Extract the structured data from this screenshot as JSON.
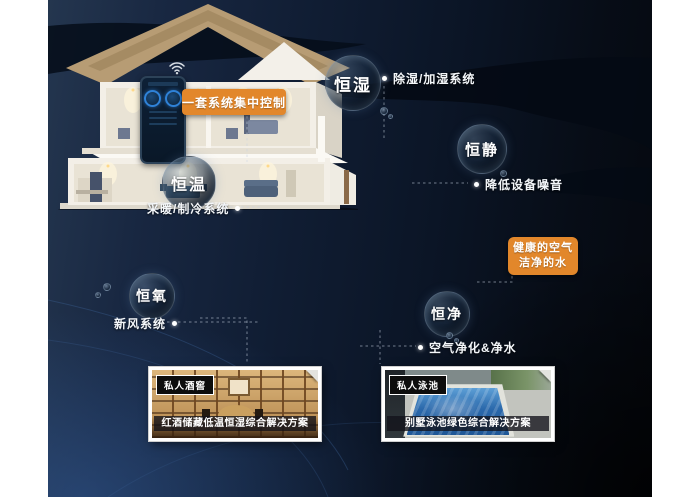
{
  "icons": {
    "phone_wifi": "wifi-icon",
    "corner_fold": "corner-fold-icon",
    "connector_dot": "connector-dot"
  },
  "colors": {
    "accent_orange": "#E2872B",
    "background_navy": "#111F35",
    "deep_shadow": "#05080E",
    "curve_line_blue": "#3F679F",
    "pool_blue": "#2A68AB",
    "wood_tan": "#C79E63",
    "roof_tan": "#B79C74",
    "text_white": "#FFFFFF"
  },
  "control_label": {
    "text": "一套系统集中控制"
  },
  "features": [
    {
      "bubble": "恒湿",
      "desc": "除湿/加湿系统"
    },
    {
      "bubble": "恒静",
      "desc": "降低设备噪音"
    },
    {
      "bubble": "恒温",
      "desc": "采暖/制冷系统"
    },
    {
      "bubble": "恒氧",
      "desc": "新风系统"
    },
    {
      "bubble": "恒净",
      "desc": "空气净化&净水"
    }
  ],
  "highlight": {
    "line1": "健康的空气",
    "line2": "洁净的水"
  },
  "cards": [
    {
      "tag": "私人酒窖",
      "caption": "红酒储藏低温恒湿综合解决方案"
    },
    {
      "tag": "私人泳池",
      "caption": "别墅泳池绿色综合解决方案"
    }
  ]
}
